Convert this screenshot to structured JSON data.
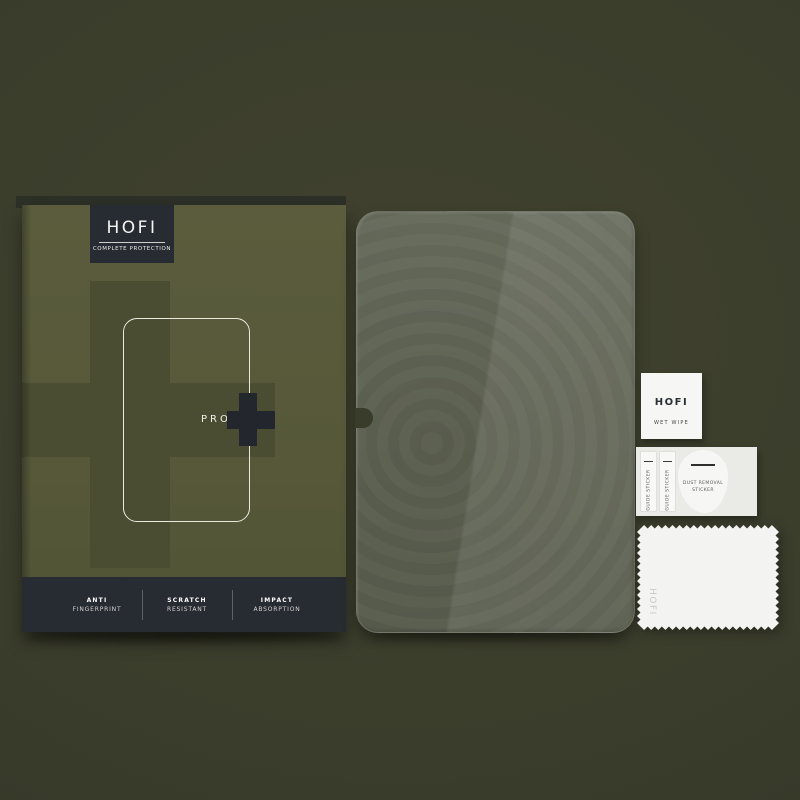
{
  "box": {
    "brand": "HOFI",
    "tagline": "COMPLETE PROTECTION",
    "model": "PRO",
    "plus_icon": "+",
    "features": [
      {
        "line1": "ANTI",
        "line2": "FINGERPRINT"
      },
      {
        "line1": "SCRATCH",
        "line2": "RESISTANT"
      },
      {
        "line1": "IMPACT",
        "line2": "ABSORPTION"
      }
    ]
  },
  "glass": {
    "description": "transparent tempered glass pane with camera notch"
  },
  "accessories": {
    "wet_wipe": {
      "brand": "HOFI",
      "label": "WET WIPE"
    },
    "guide_stickers": [
      {
        "label": "GUIDE STICKER"
      },
      {
        "label": "GUIDE STICKER"
      }
    ],
    "dust_removal": {
      "line1": "DUST REMOVAL",
      "line2": "STICKER"
    },
    "cloth": {
      "brand": "HOFI"
    }
  },
  "colors": {
    "background": "#3b3d2c",
    "box_olive": "#565839",
    "box_dark_olive": "#4a4d31",
    "dark_panel": "#272b32",
    "glass": "#5e6252",
    "white_items": "#f4f4f2",
    "outline_cream": "#ebe9de"
  }
}
